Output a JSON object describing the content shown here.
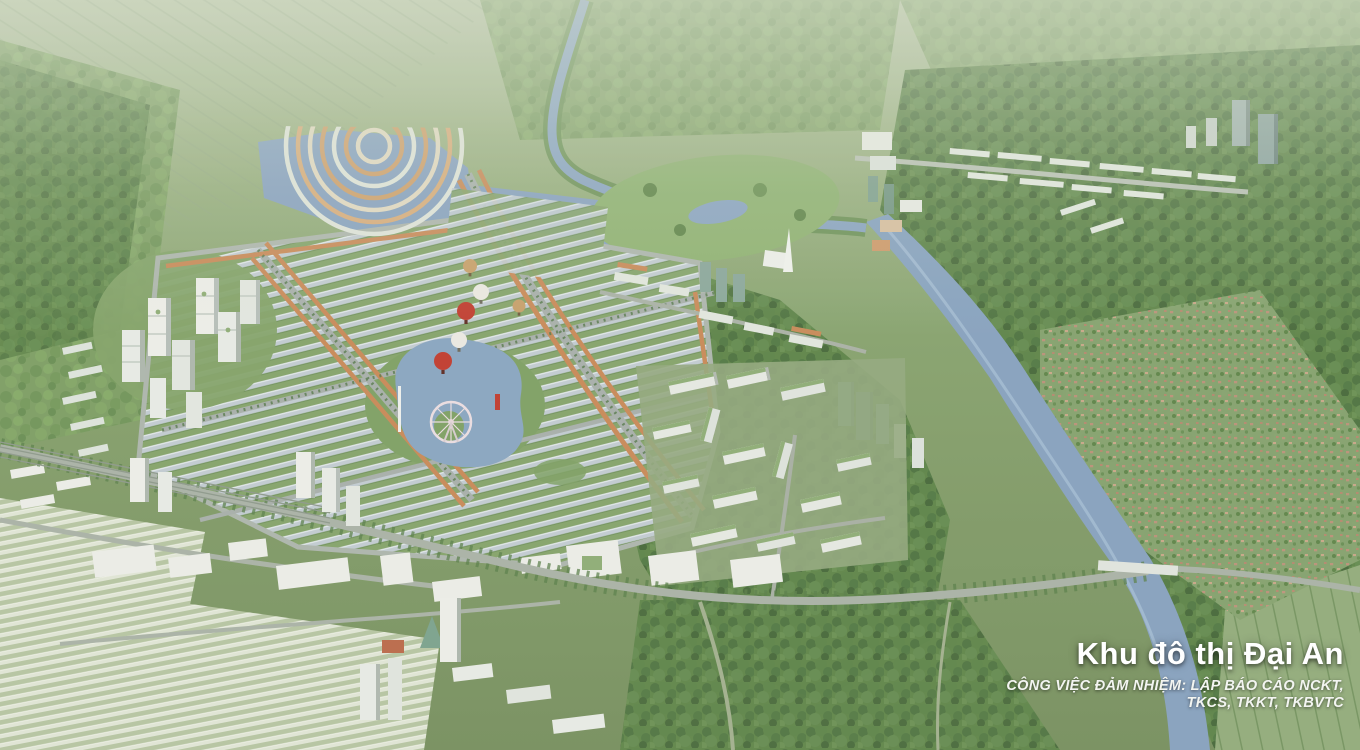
{
  "overlay": {
    "title": "Khu đô thị Đại An",
    "subtitle_line1": "CÔNG VIỆC ĐẢM NHIỆM: LẬP BÁO CÁO NCKT,",
    "subtitle_line2": "TKCS, TKKT, TKBVTC"
  },
  "scene": {
    "colors": {
      "landscape_green": "#86a26d",
      "forest_green": "#5f8549",
      "water_blue": "#87a2c0",
      "roof_orange": "#c98a58",
      "building_white": "#e9ece7",
      "balloon_red": "#c23b2e",
      "overlay_text": "#ffffff"
    }
  }
}
